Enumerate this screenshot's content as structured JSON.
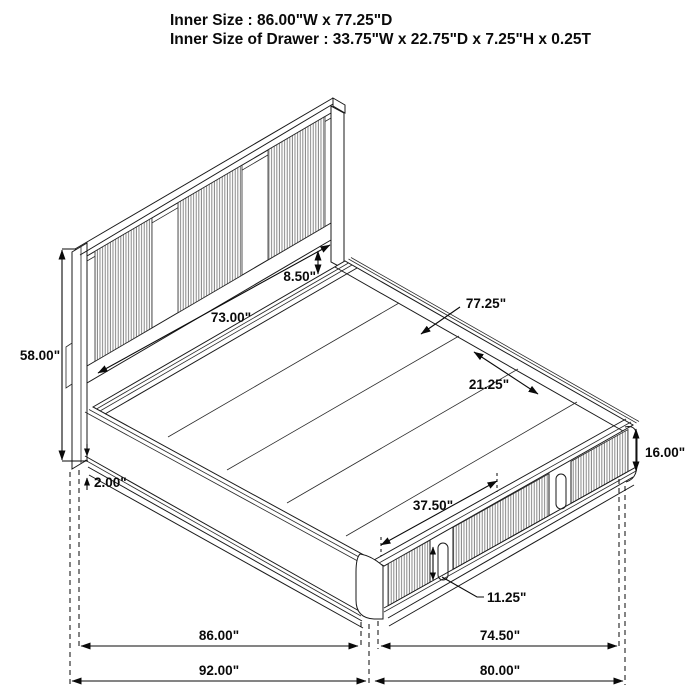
{
  "header": {
    "line1": "Inner Size : 86.00\"W x 77.25\"D",
    "line2": "Inner Size of Drawer : 33.75\"W x 22.75\"D x 7.25\"H x 0.25T"
  },
  "dims": {
    "headboard_height": "58.00\"",
    "headboard_inner_width": "73.00\"",
    "headboard_gap": "8.50\"",
    "inner_depth": "77.25\"",
    "slat_width": "21.25\"",
    "base_height": "16.00\"",
    "base_recess": "2.00\"",
    "drawer_span": "37.50\"",
    "handle_height": "11.25\"",
    "inner_width": "86.00\"",
    "foot_width": "74.50\"",
    "overall_width": "92.00\"",
    "overall_length": "80.00\""
  },
  "colors": {
    "line": "#1a1a1a",
    "rib": "#7a7a7a",
    "text": "#0a0a0a",
    "background": "#ffffff"
  }
}
